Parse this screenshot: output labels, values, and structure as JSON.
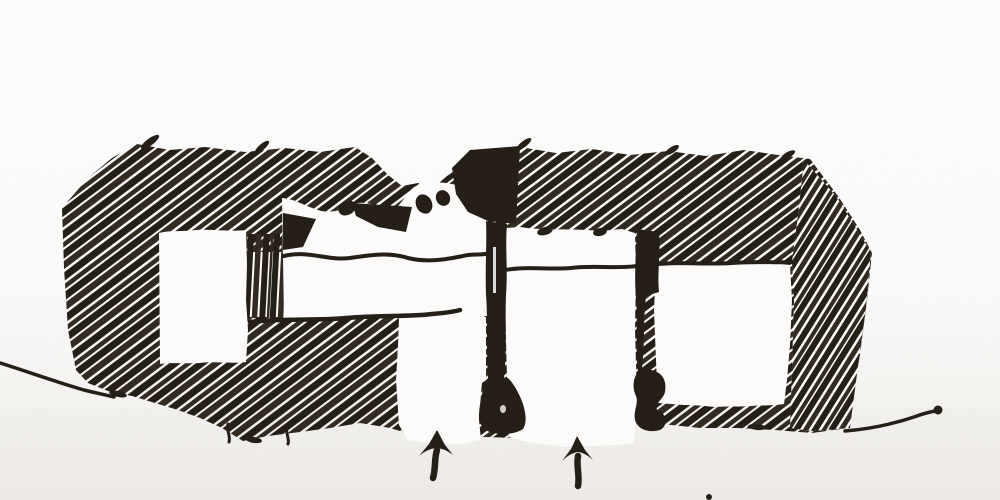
{
  "scene": {
    "kind": "ink-sketch-photo",
    "subject": "hand-drawn architectural section sketch with hatched poche, room voids, ground line and two entry arrows"
  },
  "colors": {
    "ink": "#261f17",
    "ink_soft": "#332b21",
    "paper": "#fcfbfa",
    "paper_shade": "#efede9",
    "noise_tint": "#8a857d"
  },
  "sketch": {
    "mass": "building-poche",
    "rooms": [
      "left-room",
      "central-room",
      "mid-gap",
      "right-room",
      "left-entry-gap"
    ],
    "lines": [
      "mezzanine-line",
      "floor-line",
      "porch-line",
      "right-room-ceiling-line",
      "ground-line-left",
      "ground-line-right"
    ],
    "arrows": [
      {
        "id": "entry-arrow-left",
        "direction": "up"
      },
      {
        "id": "entry-arrow-right",
        "direction": "up"
      }
    ]
  }
}
